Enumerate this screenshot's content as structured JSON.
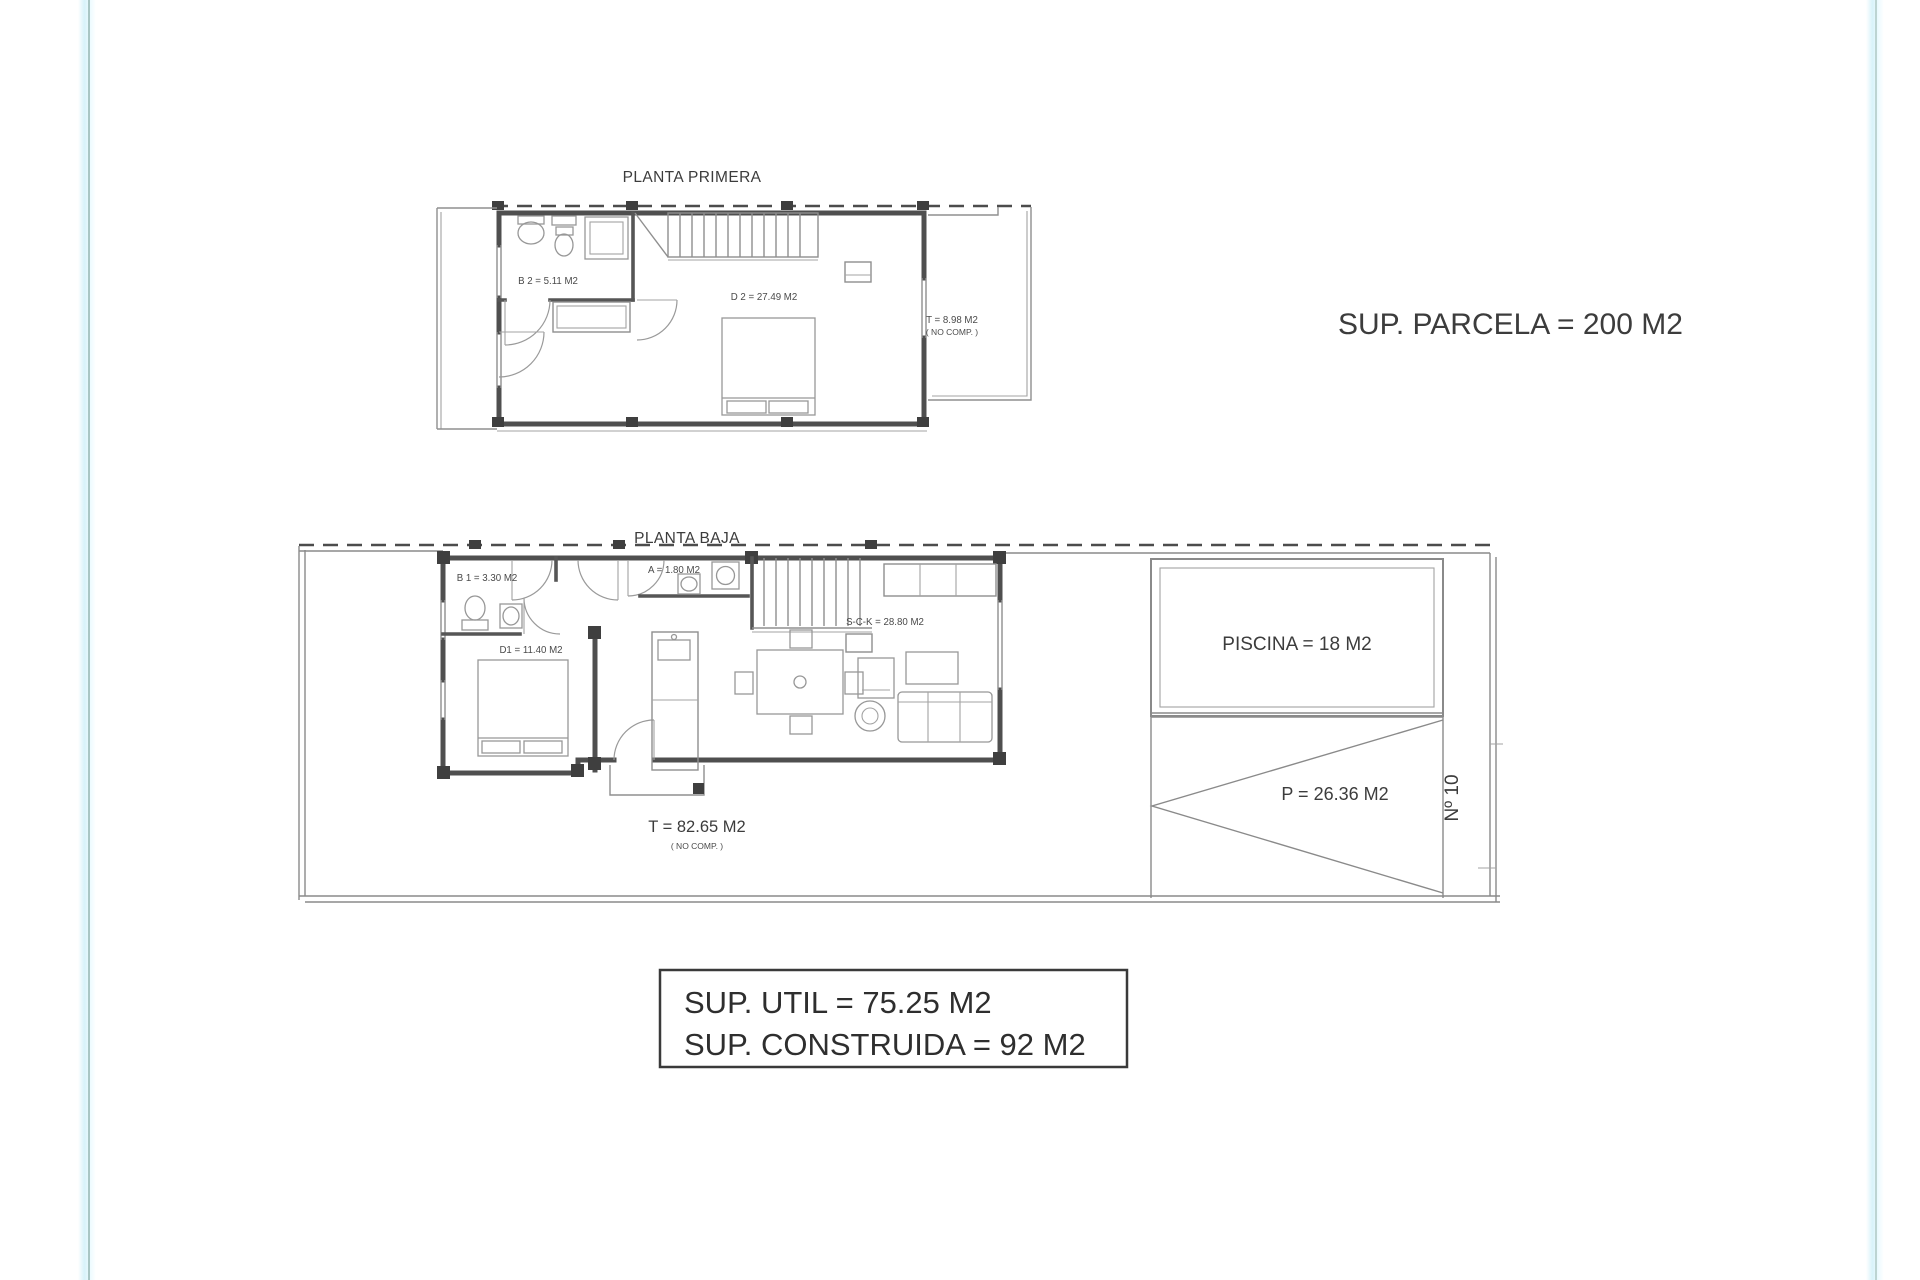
{
  "page": {
    "background": "#ffffff",
    "edge_line_color": "#a9c6c4",
    "edge_glow_color": "#d8f3fa",
    "wall_color": "#4f4f4f",
    "thin_line_color": "#8f8f8f",
    "text_color": "#3c3c3c"
  },
  "plans": {
    "first": {
      "title": "PLANTA PRIMERA",
      "rooms": {
        "b2": {
          "label": "B 2 = 5.11 M2"
        },
        "d2": {
          "label": "D 2 = 27.49 M2"
        },
        "terrace": {
          "label": "T = 8.98 M2",
          "note": "( NO COMP. )"
        }
      }
    },
    "ground": {
      "title": "PLANTA BAJA",
      "rooms": {
        "b1": {
          "label": "B 1 = 3.30 M2"
        },
        "a": {
          "label": "A = 1.80 M2"
        },
        "d1": {
          "label": "D1 = 11.40 M2"
        },
        "sck": {
          "label": "S-C-K = 28.80 M2"
        },
        "terrace": {
          "label": "T = 82.65 M2",
          "note": "( NO COMP. )"
        }
      },
      "exterior": {
        "pool": "PISCINA = 18 M2",
        "parking": "P = 26.36 M2",
        "street_number": "Nº 10"
      }
    }
  },
  "annotations": {
    "parcel_area": "SUP. PARCELA = 200 M2",
    "summary": {
      "util": "SUP. UTIL = 75.25 M2",
      "built": "SUP. CONSTRUIDA = 92 M2"
    }
  }
}
